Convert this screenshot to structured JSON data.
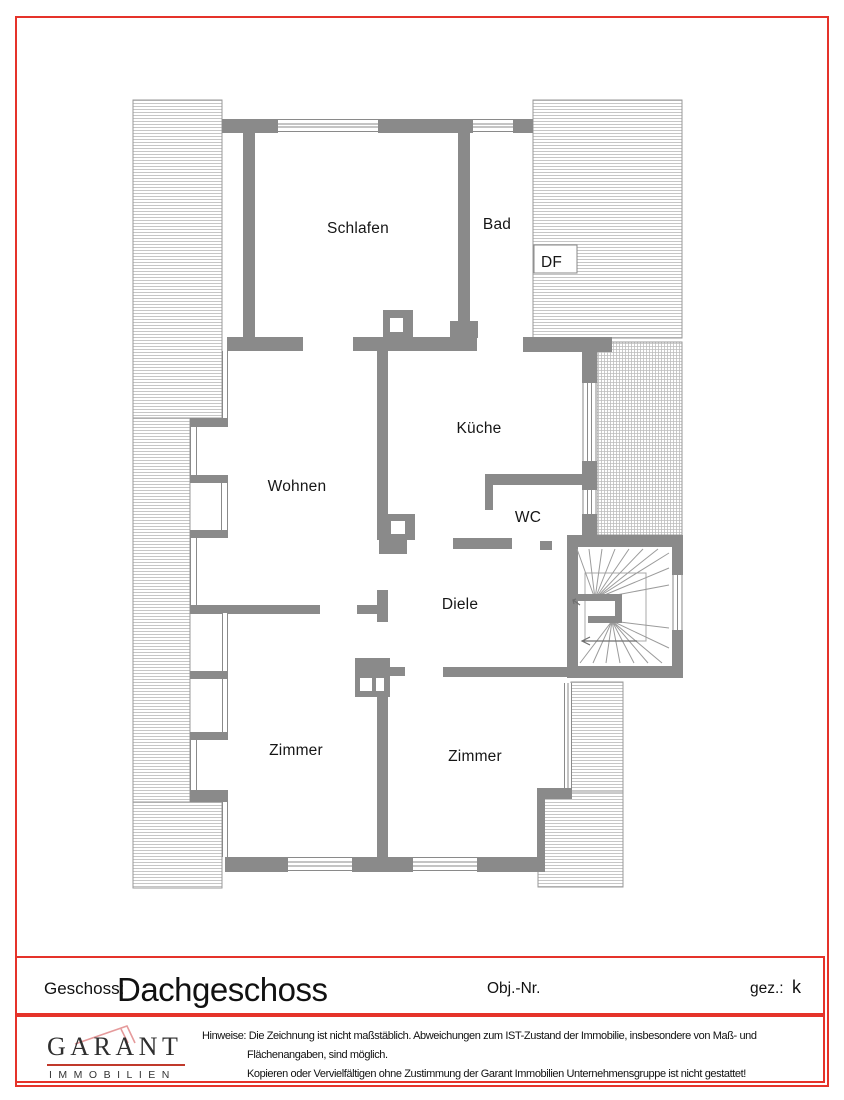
{
  "page": {
    "border_color": "#e5332a",
    "background": "#ffffff"
  },
  "floor_plan": {
    "rooms": [
      {
        "label": "Schlafen"
      },
      {
        "label": "Bad"
      },
      {
        "label": "DF"
      },
      {
        "label": "Küche"
      },
      {
        "label": "Wohnen"
      },
      {
        "label": "WC"
      },
      {
        "label": "Diele"
      },
      {
        "label": "Zimmer"
      },
      {
        "label": "Zimmer"
      }
    ],
    "colors": {
      "wall": "#8a8a8a",
      "hatch_line": "#c6c6c6",
      "outline": "#9a9a9a"
    }
  },
  "title_block": {
    "floor_label": "Geschoss:",
    "floor_value": "Dachgeschoss",
    "object_number_label": "Obj.-Nr.",
    "drawn_by_label": "gez.:",
    "drawn_by_value": "k"
  },
  "footer": {
    "logo_name": "GARANT",
    "logo_subtitle": "IMMOBILIEN",
    "notice_label": "Hinweise:",
    "notice_line1": "Die Zeichnung ist nicht maßstäblich. Abweichungen zum IST-Zustand der Immobilie, insbesondere von Maß- und",
    "notice_line2": "Flächenangaben, sind möglich.",
    "notice_line3": "Kopieren oder Vervielfältigen ohne Zustimmung der Garant Immobilien Unternehmensgruppe ist nicht gestattet!"
  }
}
